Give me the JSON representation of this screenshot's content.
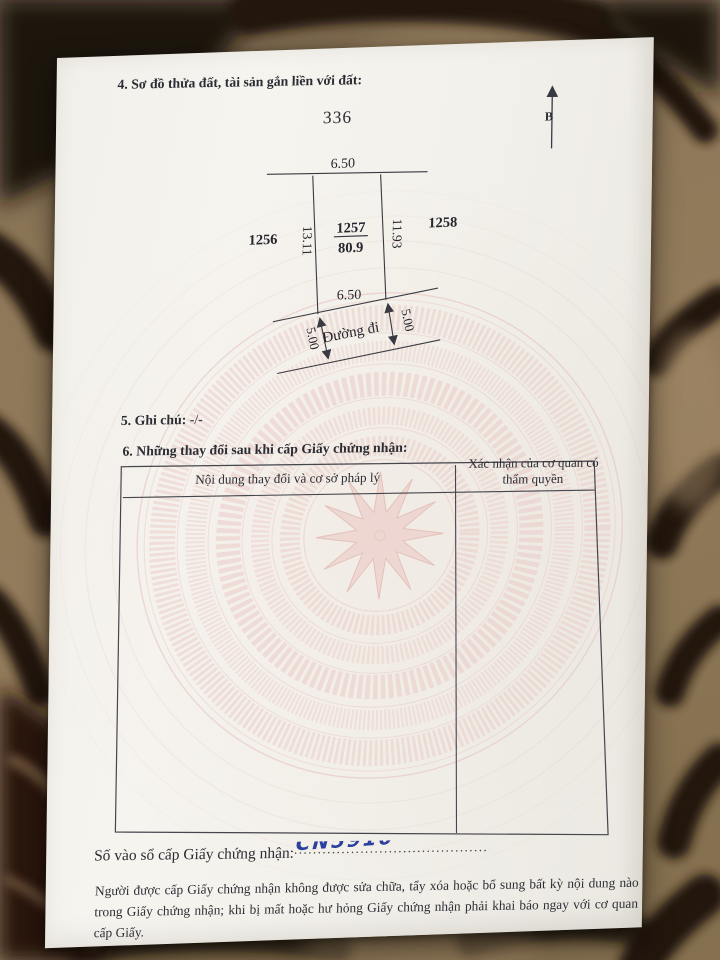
{
  "document": {
    "section4": {
      "heading": "4. Sơ đồ thửa đất, tài sản gắn liền với đất:",
      "sheet_number": "336",
      "north_label": "B"
    },
    "diagram": {
      "parcels": {
        "left": "1256",
        "center": "1257",
        "center_area": "80.9",
        "right": "1258"
      },
      "dimensions": {
        "top": "6.50",
        "left_side": "13.11",
        "right_side": "11.93",
        "bottom": "6.50",
        "road_left": "5.00",
        "road_right": "5.00"
      },
      "road_label": "Đường đi"
    },
    "section5": {
      "heading": "5. Ghi chú:",
      "value": "-/-"
    },
    "section6": {
      "heading": "6. Những thay đổi sau khi cấp Giấy chứng nhận:",
      "table": {
        "col1_header": "Nội dung thay đổi và cơ sở pháp lý",
        "col2_header": "Xác nhận của cơ quan có thẩm quyền"
      }
    },
    "registry": {
      "label": "Số vào sổ cấp Giấy chứng nhận:",
      "value": "CN5910",
      "dots": "......................................................"
    },
    "notice": "Người được cấp Giấy chứng nhận không được sửa chữa, tẩy xóa hoặc bổ sung bất kỳ nội dung nào trong Giấy chứng nhận; khi bị mất hoặc hư hỏng Giấy chứng nhận phải khai báo ngay với cơ quan cấp Giấy."
  },
  "colors": {
    "ink": "#2c2c34",
    "handwriting_blue": "#2b3f9e",
    "watermark_pink": "#e6c0ba",
    "paper": "#f3f1eb",
    "fabric_tan": "#8d7758",
    "fabric_dark": "#221709"
  }
}
